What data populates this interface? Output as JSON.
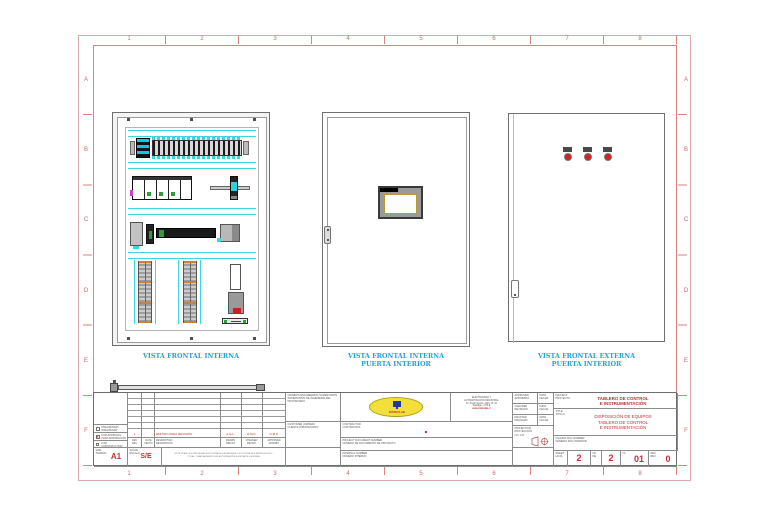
{
  "frame": {
    "columns": [
      "1",
      "2",
      "3",
      "4",
      "5",
      "6",
      "7",
      "8"
    ],
    "rows": [
      "A",
      "B",
      "C",
      "D",
      "E",
      "F"
    ]
  },
  "views": {
    "internal": {
      "caption": "VISTA FRONTAL INTERNA"
    },
    "door_internal": {
      "caption": "VISTA FRONTAL INTERNA\nPUERTA INTERIOR"
    },
    "door_external": {
      "caption": "VISTA FRONTAL EXTERNA\nPUERTA INTERIOR"
    }
  },
  "titleblock": {
    "status_preliminary": "PRELIMINARY\nPRELIMINAR",
    "status_approval": "FOR APPROVAL\nPARA APROBACIÓN",
    "status_approval_mark": "X",
    "status_construction": "FOR CONSTRUCTION\nPARA CONSTRUCCIÓN",
    "size_label": "SIZE\nTAMAÑO",
    "size_value": "A1",
    "scale_label": "SCALE\nESCALA",
    "scale_value": "S/E",
    "note": "ESTE PLANO ES PROPIEDAD EXCLUSIVA DE LA EMPRESA Y NO PODRÁ SER REPRODUCIDO\nTOTAL O PARCIALMENTE SIN AUTORIZACIÓN ESCRITA DE LA MISMA",
    "revision": {
      "entry_rev": "1",
      "entry_description": "EMITIDO PARA REVISIÓN",
      "entry_drawn": "A.G.L.",
      "entry_checked": "G.M.P.",
      "entry_approved": "G.M.P.",
      "header_rev": "REV\nREV",
      "header_date": "DATE\nFECHA",
      "header_description": "DESCRIPTION\nDESCRIPCIÓN",
      "header_drawn": "DRAWN\nDIBUJÓ",
      "header_checked": "CHECKED\nREVISÓ",
      "header_approved": "APPROVED\nAPROBÓ"
    },
    "owner_supervision": "OWNER'S ENGINEERING SUPERVISION\nSUPERVISIÓN DE INGENIERÍA DEL PROPIETARIO",
    "customer": "CUSTOMER (OWNER)\nCLIENTE (PROPIETARIO)",
    "logo_text": "INSTRULAB",
    "company_info": "ELECTRICIDAD Y\nAUTOMATIZACIÓN INDUSTRIAL\nAv. Pedro Aguirre 1123, Of. 34\nSantiago - CHILE",
    "company_web": "www.instrulab.cl",
    "contractor": "CONTRACTOR\nCONTRATISTA",
    "project_doc_number": "PROJECT DOCUMENT NUMBER\nNÚMERO DE DOCUMENTO DE PROYECTO",
    "internal_number": "INTERNAL NUMBER\nNÚMERO INTERNO",
    "approved": "APPROVED\nAPROBADO",
    "checked": "CHECKED\nREVISADO",
    "drafted": "DRAFTED\nDIBUJADO",
    "date": "DATE\nFECHA",
    "projection": "PROJECTION\nPROYECCIÓN",
    "projection_std": "ISO 128",
    "project_label": "PROJECT\nPROYECTO",
    "project_name": "TABLERO DE CONTROL\nE INSTRUMENTACIÓN",
    "title_label": "TITLE\nTÍTULO",
    "title_text": "DISPOSICIÓN DE EQUIPOS\nTABLERO DE CONTROL\nE INSTRUMENTACIÓN",
    "folder_doc_number": "FOLDER DOC NUMBER\nNÚMERO DOC INTERIOR",
    "sheet_label": "SHEET\nHOJA",
    "sheet_value": "2",
    "of_label": "OF\nDE",
    "of_value": "2",
    "cl_label": "CL",
    "cl_value": "01",
    "rev_label": "REV\nREV",
    "rev_value": "0"
  },
  "colors": {
    "frame_red": "#d9827f",
    "caption_cyan": "#1ba7d9",
    "accent_red": "#c03030",
    "logo_yellow": "#f2df3a",
    "component_cyan": "#3fd6e0",
    "component_green": "#2f9e38"
  }
}
